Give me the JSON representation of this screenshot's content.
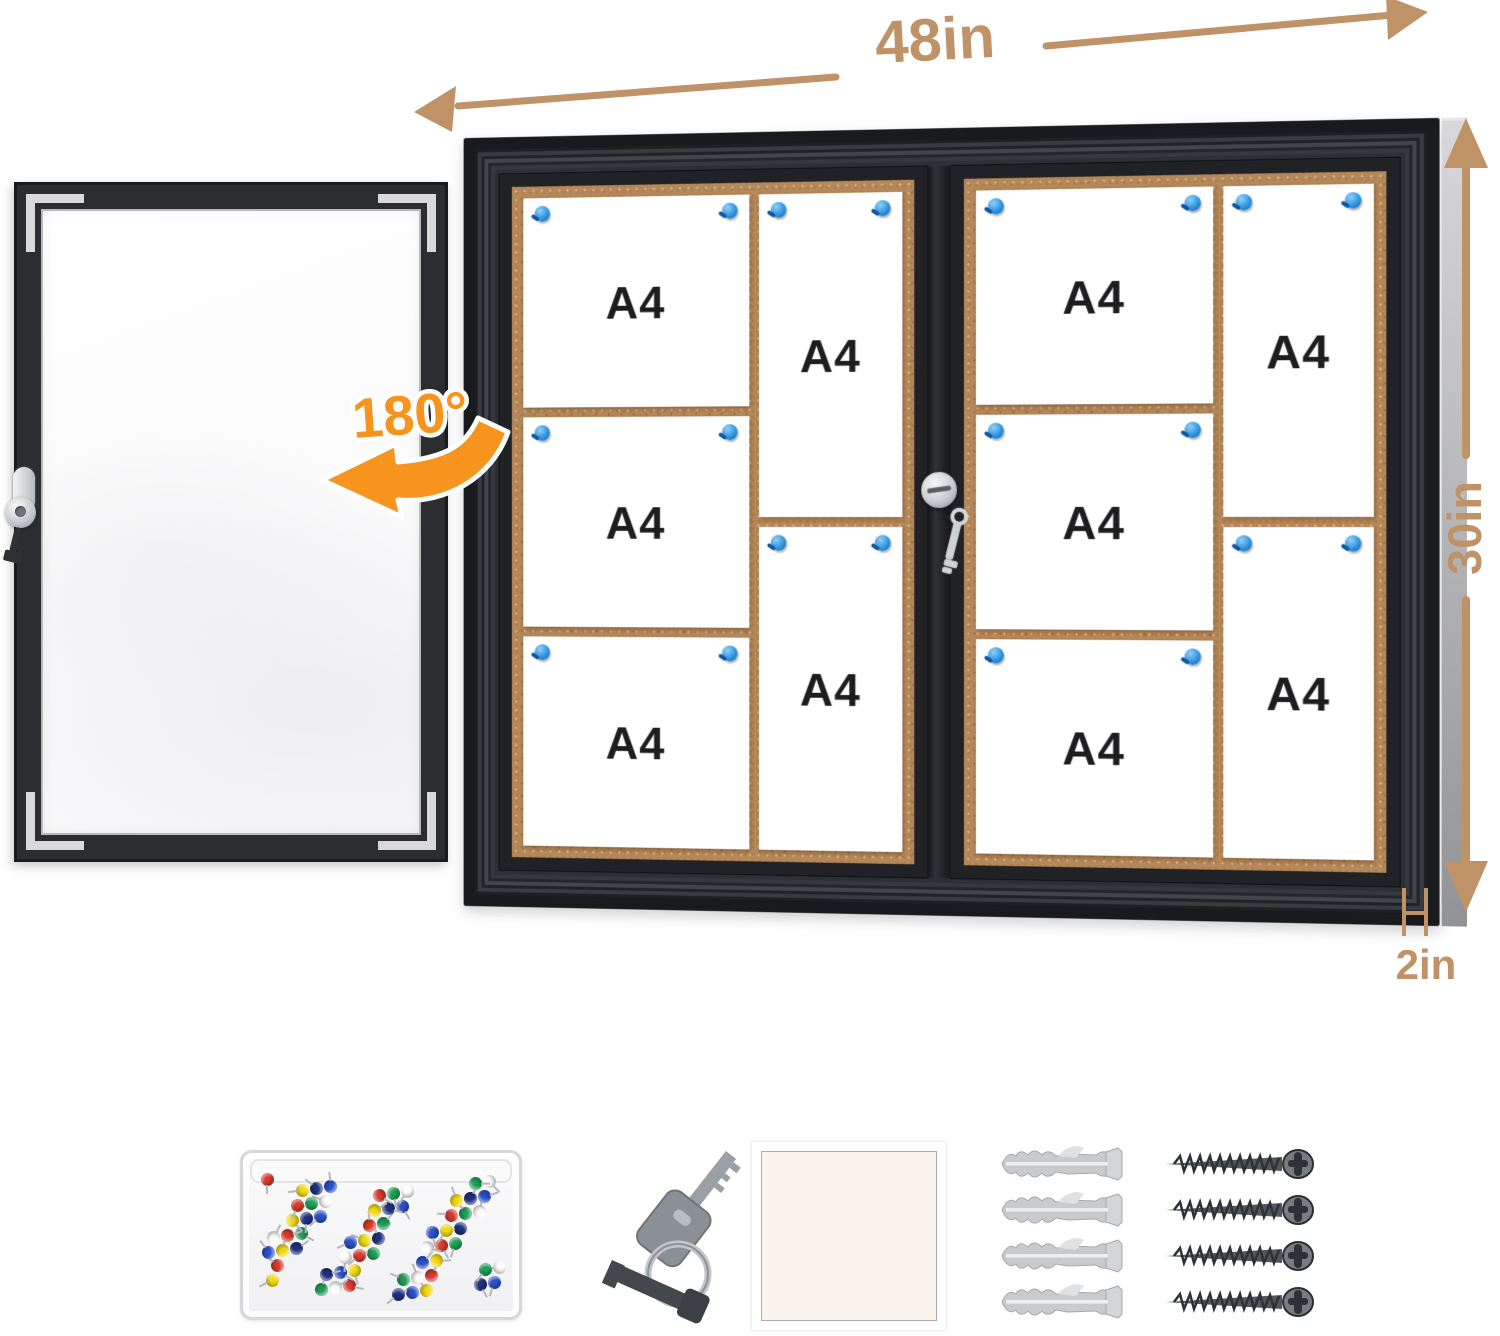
{
  "annotations": {
    "width": "48in",
    "height": "30in",
    "depth": "2in",
    "door_rotation": "180°"
  },
  "board": {
    "paper_label": "A4"
  },
  "colors": {
    "dimension_text": "#bf9268",
    "rotation_accent": "#f7941d",
    "cork": "#b5885a",
    "frame": "#1b1c1f",
    "pin_blue": "#2f93e0"
  },
  "accessories": {
    "pushpin_box": {
      "pin_count": 64,
      "pin_colors": [
        "#d93a2b",
        "#2b50c8",
        "#1f9e57",
        "#f2d912",
        "#fdfdfd",
        "#20317e"
      ]
    },
    "keys_count": 2,
    "anchors_count": 4,
    "screws_count": 4
  }
}
